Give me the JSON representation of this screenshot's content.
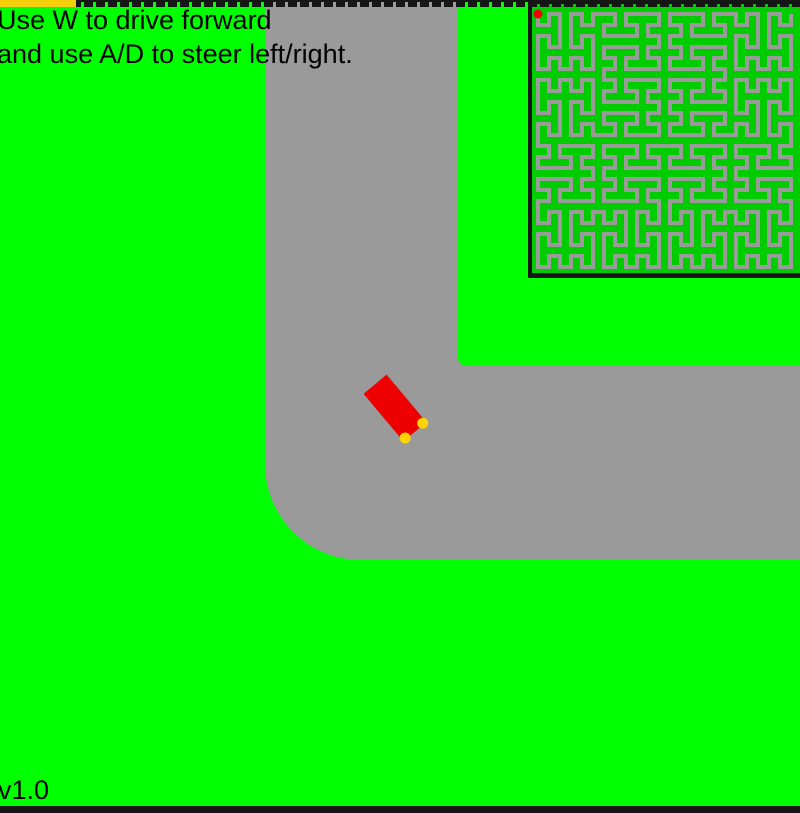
{
  "hud": {
    "instructions_line1": "Use W to drive forward",
    "instructions_line2": "and use A/D to steer left/right.",
    "version": "v1.0"
  },
  "game": {
    "car": {
      "color": "#EE0000",
      "headlight_color": "#FFD400",
      "heading_deg": -40
    },
    "minimap": {
      "background": "#00CC00",
      "track_color": "#9A9A9A",
      "border_color": "#141414",
      "player_dot_color": "#EE0000"
    },
    "colors": {
      "grass": "#00FF00",
      "road": "#9A9A9A",
      "top_bar_yellow": "#F6CF0C",
      "world_border": "#161616"
    }
  }
}
